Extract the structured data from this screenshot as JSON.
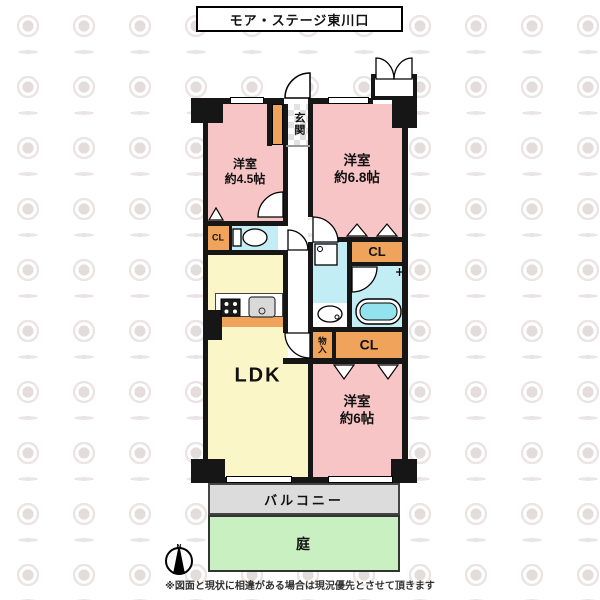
{
  "title": "モア・ステージ東川口",
  "rooms": {
    "room_45": {
      "name": "洋室",
      "size": "約4.5帖"
    },
    "room_68": {
      "name": "洋室",
      "size": "約6.8帖"
    },
    "room_6": {
      "name": "洋室",
      "size": "約6帖"
    },
    "ldk": {
      "name": "LDK"
    },
    "genkan": {
      "name": "玄関"
    },
    "balcony": {
      "name": "バルコニー"
    },
    "garden": {
      "name": "庭"
    },
    "closet": {
      "name": "CL"
    },
    "storage": {
      "name": "物入"
    }
  },
  "compass": {
    "north": "N"
  },
  "disclaimer": "※図面と現状に相違がある場合は現況優先とさせて頂きます",
  "colors": {
    "room_pink": "#F7C5C5",
    "ldk_yellow": "#FAF6C8",
    "wet_cyan": "#C2EDF4",
    "closet_orange": "#F0A35A",
    "balcony_gray": "#DCDCDC",
    "garden_green": "#C9F0C0",
    "wall_black": "#161616"
  }
}
